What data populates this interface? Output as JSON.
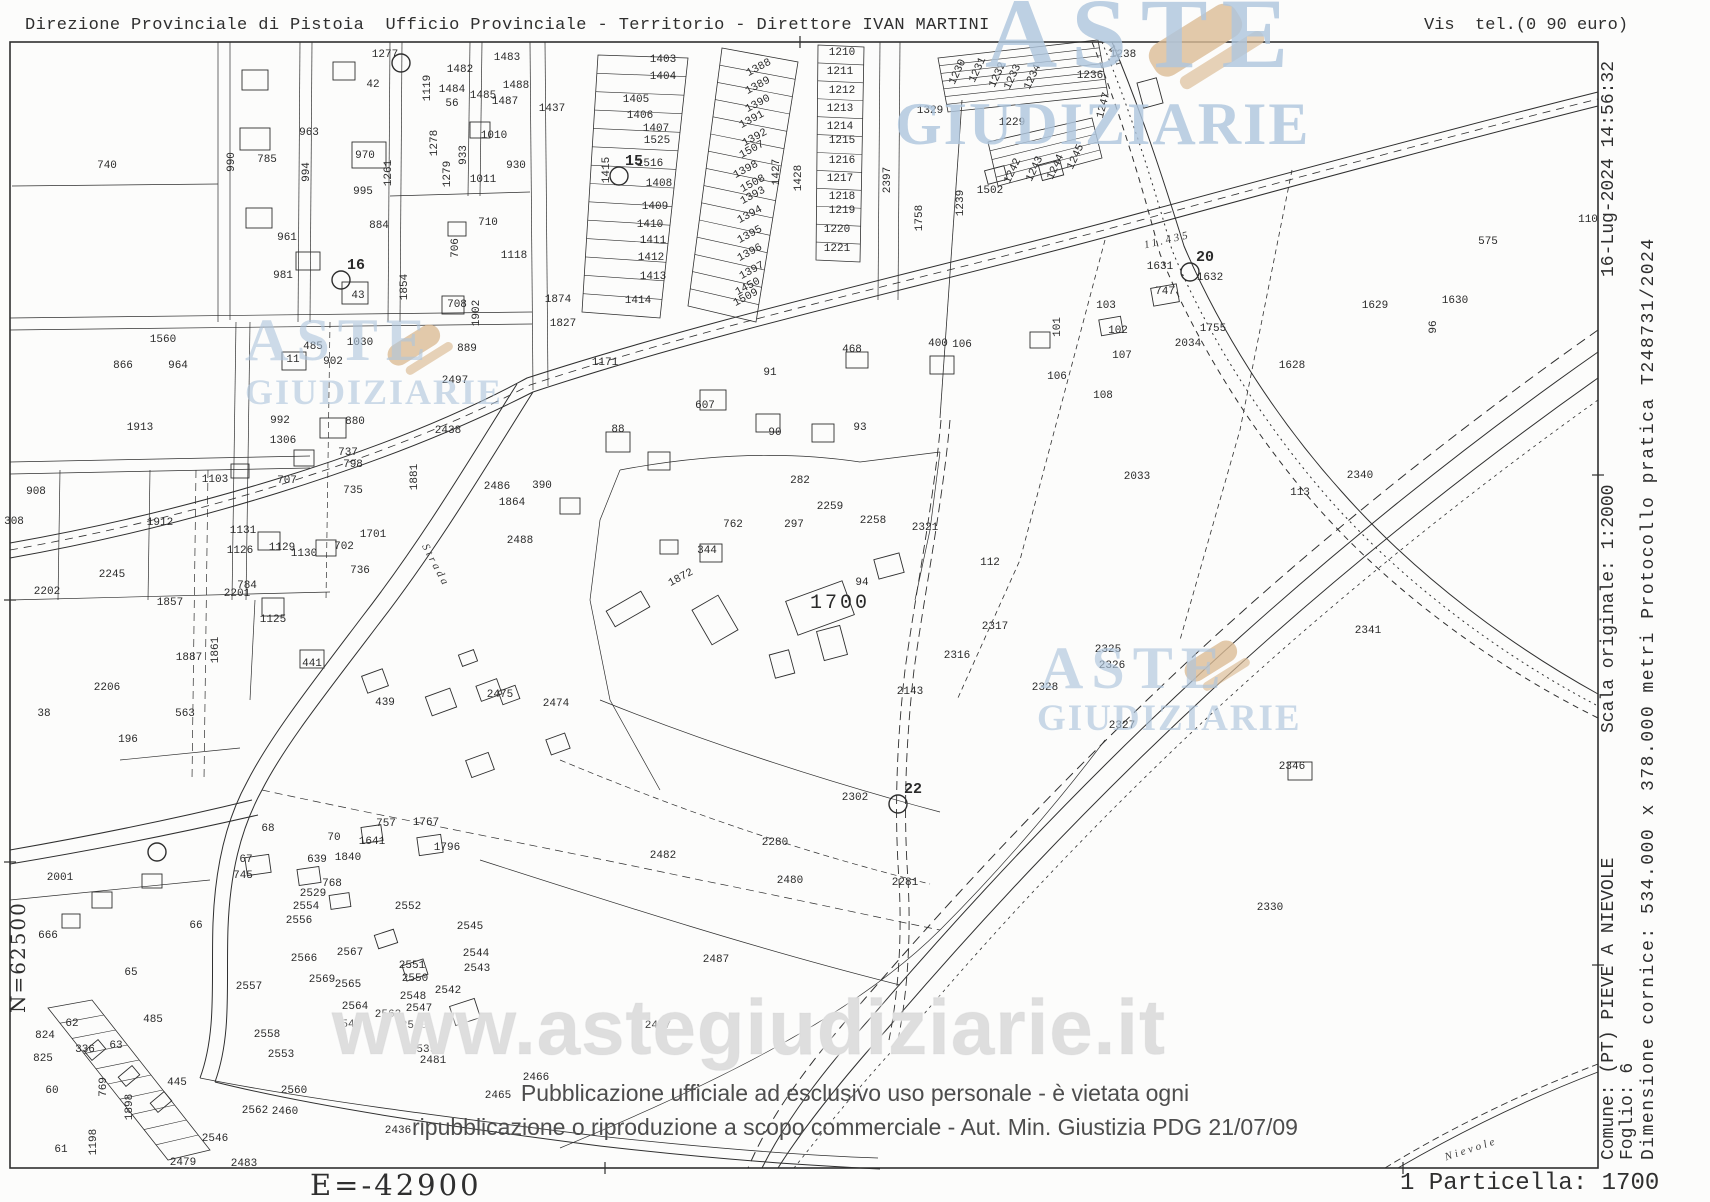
{
  "header": {
    "left": "Direzione Provinciale di Pistoia  Ufficio Provinciale - Territorio - Direttore IVAN MARTINI",
    "right": "Vis  tel.(0 90 euro)"
  },
  "margins": {
    "north_label": "N=62500",
    "east_label": "E=-42900",
    "particella_label": "1 Particella: 1700",
    "comune_line1": "Comune: (PT) PIEVE A NIEVOLE",
    "comune_line2": "Foglio: 6",
    "scala": "Scala originale: 1:2000",
    "timestamp": "16-Lug-2024 14:56:32",
    "dimensione": "Dimensione cornice: 534.000 x 378.000 metri",
    "protocollo": "Protocollo pratica T248731/2024"
  },
  "watermarks": {
    "logo_word1": "ASTE",
    "logo_word2": "GIUDIZIARIE",
    "url": "www.astegiudiziarie.it",
    "disclaimer_line1": "Pubblicazione ufficiale ad esclusivo uso personale - è vietata ogni",
    "disclaimer_line2": "ripubblicazione o riproduzione a scopo commerciale - Aut. Min. Giustizia PDG 21/07/09"
  },
  "colors": {
    "ink": "#2f2f2f",
    "watermark_blue": "rgba(175,198,221,0.82)",
    "watermark_tan": "rgba(219,188,150,0.8)",
    "url_gray": "#d8d8d8",
    "disclaimer_gray": "#4d4d4d"
  },
  "map": {
    "subject_parcel": "1700",
    "road_labels": [
      [
        "Strada",
        433,
        567,
        62
      ],
      [
        "Via",
        1113,
        58,
        62
      ],
      [
        "Nievole",
        1472,
        1152,
        -18
      ],
      [
        "11.435",
        1168,
        243,
        -13
      ]
    ],
    "points": [
      [
        "15",
        619,
        176
      ],
      [
        "16",
        341,
        280
      ],
      [
        "20",
        1190,
        272
      ],
      [
        "22",
        898,
        804
      ],
      [
        "",
        401,
        63
      ],
      [
        "",
        157,
        852
      ]
    ],
    "labels": [
      [
        "740",
        107,
        168
      ],
      [
        "1277",
        385,
        57
      ],
      [
        "42",
        373,
        87
      ],
      [
        "1482",
        460,
        72
      ],
      [
        "1483",
        507,
        60
      ],
      [
        "1484",
        452,
        92
      ],
      [
        "1485",
        483,
        98
      ],
      [
        "1488",
        516,
        88
      ],
      [
        "1487",
        505,
        104
      ],
      [
        "1119",
        430,
        88,
        -90
      ],
      [
        "56",
        452,
        106
      ],
      [
        "963",
        309,
        135
      ],
      [
        "785",
        267,
        162
      ],
      [
        "990",
        234,
        162,
        -90
      ],
      [
        "994",
        309,
        172,
        -90
      ],
      [
        "970",
        365,
        158
      ],
      [
        "1261",
        391,
        173,
        -90
      ],
      [
        "1278",
        437,
        143,
        -90
      ],
      [
        "1279",
        450,
        174,
        -90
      ],
      [
        "933",
        466,
        155,
        -90
      ],
      [
        "1010",
        494,
        138
      ],
      [
        "1011",
        483,
        182
      ],
      [
        "930",
        516,
        168
      ],
      [
        "995",
        363,
        194
      ],
      [
        "961",
        287,
        240
      ],
      [
        "884",
        379,
        228
      ],
      [
        "706",
        458,
        248,
        -90
      ],
      [
        "1118",
        514,
        258
      ],
      [
        "710",
        488,
        225
      ],
      [
        "981",
        283,
        278
      ],
      [
        "43",
        358,
        298
      ],
      [
        "1854",
        407,
        287,
        -90
      ],
      [
        "708",
        457,
        307
      ],
      [
        "1902",
        479,
        313,
        -90
      ],
      [
        "11",
        293,
        362
      ],
      [
        "902",
        333,
        364
      ],
      [
        "1030",
        360,
        345
      ],
      [
        "485",
        313,
        349
      ],
      [
        "880",
        355,
        424
      ],
      [
        "992",
        280,
        423
      ],
      [
        "1306",
        283,
        443
      ],
      [
        "1881",
        417,
        477,
        -90
      ],
      [
        "737",
        348,
        455
      ],
      [
        "798",
        353,
        467
      ],
      [
        "735",
        353,
        493
      ],
      [
        "707",
        287,
        483
      ],
      [
        "1103",
        215,
        482
      ],
      [
        "1913",
        140,
        430
      ],
      [
        "1912",
        160,
        525
      ],
      [
        "1560",
        163,
        342
      ],
      [
        "964",
        178,
        368
      ],
      [
        "866",
        123,
        368
      ],
      [
        "908",
        36,
        494
      ],
      [
        "308",
        14,
        524
      ],
      [
        "2202",
        47,
        594
      ],
      [
        "2245",
        112,
        577
      ],
      [
        "1857",
        170,
        605
      ],
      [
        "1887",
        189,
        660
      ],
      [
        "1861",
        218,
        650,
        -90
      ],
      [
        "1131",
        243,
        533
      ],
      [
        "1701",
        373,
        537
      ],
      [
        "702",
        344,
        549
      ],
      [
        "1126",
        240,
        553
      ],
      [
        "1129",
        282,
        550
      ],
      [
        "1130",
        304,
        556
      ],
      [
        "736",
        360,
        573
      ],
      [
        "784",
        247,
        588
      ],
      [
        "2201",
        237,
        596
      ],
      [
        "1125",
        273,
        622
      ],
      [
        "441",
        312,
        666
      ],
      [
        "439",
        385,
        705
      ],
      [
        "2475",
        500,
        697
      ],
      [
        "2474",
        556,
        706
      ],
      [
        "2497",
        455,
        383
      ],
      [
        "2438",
        448,
        433
      ],
      [
        "889",
        467,
        351
      ],
      [
        "2488",
        520,
        543
      ],
      [
        "1864",
        512,
        505
      ],
      [
        "390",
        542,
        488
      ],
      [
        "2486",
        497,
        489
      ],
      [
        "1437",
        552,
        111
      ],
      [
        "1403",
        663,
        62
      ],
      [
        "1404",
        663,
        79
      ],
      [
        "1405",
        636,
        102
      ],
      [
        "1406",
        640,
        118
      ],
      [
        "1407",
        656,
        131
      ],
      [
        "1525",
        657,
        143
      ],
      [
        "1516",
        650,
        166
      ],
      [
        "1408",
        659,
        186
      ],
      [
        "1409",
        655,
        209
      ],
      [
        "1410",
        650,
        227
      ],
      [
        "1411",
        653,
        243
      ],
      [
        "1412",
        651,
        260
      ],
      [
        "1413",
        653,
        279
      ],
      [
        "1414",
        638,
        303
      ],
      [
        "1415",
        609,
        170,
        -90
      ],
      [
        "1388",
        760,
        70,
        -28
      ],
      [
        "1389",
        759,
        88,
        -28
      ],
      [
        "1390",
        759,
        106,
        -28
      ],
      [
        "1391",
        753,
        122,
        -28
      ],
      [
        "1392",
        756,
        140,
        -28
      ],
      [
        "1507",
        753,
        152,
        -28
      ],
      [
        "1398",
        747,
        172,
        -28
      ],
      [
        "1508",
        754,
        186,
        -28
      ],
      [
        "1393",
        754,
        198,
        -28
      ],
      [
        "1394",
        751,
        217,
        -28
      ],
      [
        "1395",
        751,
        237,
        -28
      ],
      [
        "1396",
        751,
        255,
        -28
      ],
      [
        "1397",
        753,
        273,
        -28
      ],
      [
        "1450",
        749,
        289,
        -28
      ],
      [
        "1509",
        747,
        300,
        -28
      ],
      [
        "1427",
        779,
        172,
        -90
      ],
      [
        "1428",
        801,
        178,
        -90
      ],
      [
        "1210",
        842,
        55
      ],
      [
        "1211",
        840,
        74
      ],
      [
        "1212",
        842,
        93
      ],
      [
        "1213",
        840,
        111
      ],
      [
        "1214",
        840,
        129
      ],
      [
        "1215",
        842,
        143
      ],
      [
        "1216",
        842,
        163
      ],
      [
        "1217",
        840,
        181
      ],
      [
        "1218",
        842,
        199
      ],
      [
        "1219",
        842,
        213
      ],
      [
        "1220",
        837,
        232
      ],
      [
        "1221",
        837,
        251
      ],
      [
        "1874",
        558,
        302
      ],
      [
        "1827",
        563,
        326
      ],
      [
        "1171",
        605,
        365
      ],
      [
        "1230",
        960,
        73,
        -65
      ],
      [
        "1231",
        980,
        71,
        -65
      ],
      [
        "1232",
        1000,
        76,
        -65
      ],
      [
        "1233",
        1015,
        78,
        -65
      ],
      [
        "1234",
        1035,
        78,
        -65
      ],
      [
        "1236",
        1090,
        78
      ],
      [
        "1238",
        1123,
        57
      ],
      [
        "1229",
        1012,
        125
      ],
      [
        "1242",
        1015,
        172,
        -65
      ],
      [
        "1243",
        1037,
        170,
        -65
      ],
      [
        "1244",
        1058,
        168,
        -65
      ],
      [
        "1245",
        1078,
        158,
        -65
      ],
      [
        "1502",
        990,
        193
      ],
      [
        "1239",
        963,
        203,
        -90
      ],
      [
        "1758",
        922,
        218,
        -90
      ],
      [
        "1247",
        1106,
        106,
        -75
      ],
      [
        "2397",
        890,
        180,
        -90
      ],
      [
        "1329",
        930,
        113
      ],
      [
        "88",
        618,
        432
      ],
      [
        "91",
        770,
        375
      ],
      [
        "607",
        705,
        408
      ],
      [
        "90",
        775,
        435
      ],
      [
        "93",
        860,
        430
      ],
      [
        "468",
        852,
        352
      ],
      [
        "400",
        938,
        346
      ],
      [
        "106",
        962,
        347
      ],
      [
        "101",
        1060,
        327,
        -90
      ],
      [
        "1700",
        840,
        608,
        0,
        20
      ],
      [
        "94",
        862,
        585
      ],
      [
        "1872",
        682,
        580,
        -28
      ],
      [
        "762",
        733,
        527
      ],
      [
        "344",
        707,
        553
      ],
      [
        "297",
        794,
        527
      ],
      [
        "2259",
        830,
        509
      ],
      [
        "2258",
        873,
        523
      ],
      [
        "282",
        800,
        483
      ],
      [
        "2033",
        1137,
        479
      ],
      [
        "2034",
        1188,
        346
      ],
      [
        "1755",
        1213,
        331
      ],
      [
        "103",
        1106,
        308
      ],
      [
        "102",
        1118,
        333
      ],
      [
        "107",
        1122,
        358
      ],
      [
        "106",
        1057,
        379
      ],
      [
        "108",
        1103,
        398
      ],
      [
        "747",
        1165,
        294
      ],
      [
        "1631",
        1160,
        269
      ],
      [
        "1632",
        1210,
        280
      ],
      [
        "1628",
        1292,
        368
      ],
      [
        "1629",
        1375,
        308
      ],
      [
        "1630",
        1455,
        303
      ],
      [
        "575",
        1488,
        244
      ],
      [
        "110",
        1588,
        222
      ],
      [
        "113",
        1300,
        495
      ],
      [
        "2340",
        1360,
        478
      ],
      [
        "2341",
        1368,
        633
      ],
      [
        "96",
        1436,
        327,
        -90
      ],
      [
        "2316",
        957,
        658
      ],
      [
        "2317",
        995,
        629
      ],
      [
        "2321",
        925,
        530
      ],
      [
        "112",
        990,
        565
      ],
      [
        "2143",
        910,
        694
      ],
      [
        "2325",
        1108,
        652
      ],
      [
        "2326",
        1112,
        668
      ],
      [
        "2328",
        1045,
        690
      ],
      [
        "2327",
        1122,
        728
      ],
      [
        "2346",
        1292,
        769
      ],
      [
        "2330",
        1270,
        910
      ],
      [
        "2302",
        855,
        800
      ],
      [
        "2281",
        905,
        885
      ],
      [
        "2487",
        716,
        962
      ],
      [
        "2280",
        775,
        845
      ],
      [
        "2480",
        790,
        883
      ],
      [
        "2482",
        663,
        858
      ],
      [
        "2467",
        658,
        1028
      ],
      [
        "2466",
        536,
        1080
      ],
      [
        "2465",
        498,
        1098
      ],
      [
        "2001",
        60,
        880
      ],
      [
        "666",
        48,
        938
      ],
      [
        "66",
        196,
        928
      ],
      [
        "65",
        131,
        975
      ],
      [
        "67",
        246,
        862
      ],
      [
        "745",
        243,
        878
      ],
      [
        "68",
        268,
        831
      ],
      [
        "70",
        334,
        840
      ],
      [
        "757",
        386,
        826
      ],
      [
        "1767",
        426,
        825
      ],
      [
        "1796",
        447,
        850
      ],
      [
        "639",
        317,
        862
      ],
      [
        "1840",
        348,
        860
      ],
      [
        "1641",
        372,
        844
      ],
      [
        "768",
        332,
        886
      ],
      [
        "2529",
        313,
        896
      ],
      [
        "2554",
        306,
        909
      ],
      [
        "2556",
        299,
        923
      ],
      [
        "2566",
        304,
        961
      ],
      [
        "2569",
        322,
        982
      ],
      [
        "2565",
        348,
        987
      ],
      [
        "2567",
        350,
        955
      ],
      [
        "2552",
        408,
        909
      ],
      [
        "2545",
        470,
        929
      ],
      [
        "2544",
        476,
        956
      ],
      [
        "2543",
        477,
        971
      ],
      [
        "2551",
        412,
        968
      ],
      [
        "2550",
        415,
        981
      ],
      [
        "2548",
        413,
        999
      ],
      [
        "2542",
        448,
        993
      ],
      [
        "2547",
        419,
        1011
      ],
      [
        "2563",
        388,
        1017
      ],
      [
        "2540",
        414,
        1028
      ],
      [
        "2541",
        348,
        1027
      ],
      [
        "2564",
        355,
        1009
      ],
      [
        "2558",
        267,
        1037
      ],
      [
        "2553",
        281,
        1057
      ],
      [
        "2557",
        249,
        989
      ],
      [
        "2560",
        294,
        1093
      ],
      [
        "2562",
        255,
        1113
      ],
      [
        "2460",
        285,
        1114
      ],
      [
        "2546",
        215,
        1141
      ],
      [
        "2479",
        183,
        1165
      ],
      [
        "2483",
        244,
        1166
      ],
      [
        "2539",
        423,
        1052
      ],
      [
        "2481",
        433,
        1063
      ],
      [
        "2436",
        398,
        1133
      ],
      [
        "62",
        72,
        1026
      ],
      [
        "824",
        45,
        1038
      ],
      [
        "825",
        43,
        1061
      ],
      [
        "336",
        85,
        1052
      ],
      [
        "63",
        116,
        1048
      ],
      [
        "60",
        52,
        1093
      ],
      [
        "61",
        61,
        1152
      ],
      [
        "445",
        177,
        1085
      ],
      [
        "485",
        153,
        1022
      ],
      [
        "769",
        106,
        1087,
        -90
      ],
      [
        "1898",
        132,
        1107,
        -90
      ],
      [
        "1198",
        96,
        1142,
        -90
      ],
      [
        "196",
        128,
        742
      ],
      [
        "563",
        185,
        716
      ],
      [
        "38",
        44,
        716
      ],
      [
        "2206",
        107,
        690
      ]
    ]
  }
}
